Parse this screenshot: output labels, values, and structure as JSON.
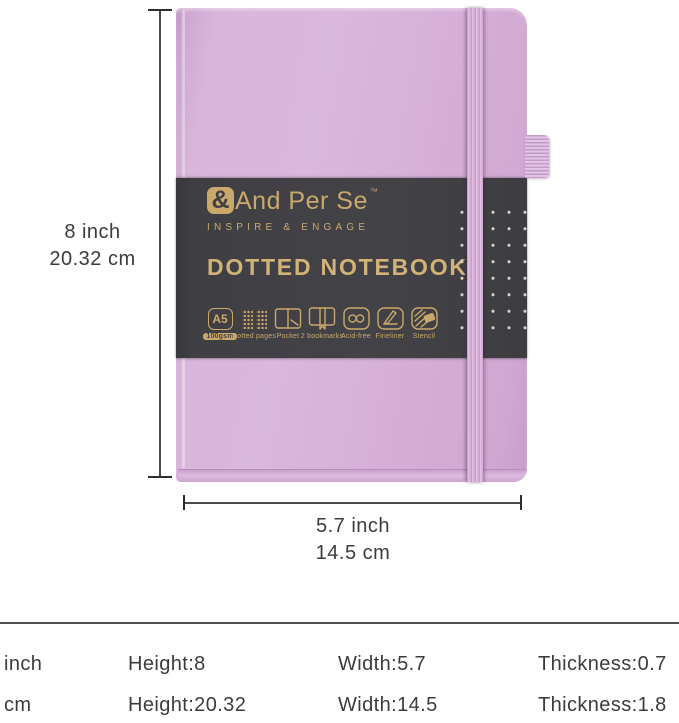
{
  "colors": {
    "cover": "#d6b0d8",
    "belly_band": "#403f44",
    "gold_foil": "#c9a96b",
    "annotation_text": "#3b3b3b"
  },
  "brand": {
    "mark": "&",
    "name": "And Per Se",
    "trademark": "™",
    "tagline": "INSPIRE & ENGAGE"
  },
  "product": {
    "title": "DOTTED NOTEBOOK",
    "features": [
      {
        "icon": "a5-paper-size-icon",
        "badge": "A5",
        "label": "100gsm"
      },
      {
        "icon": "dotted-pages-icon",
        "label": "Dotted pages"
      },
      {
        "icon": "pocket-icon",
        "label": "Pocket"
      },
      {
        "icon": "two-bookmarks-icon",
        "label": "2 bookmarks"
      },
      {
        "icon": "acid-free-icon",
        "label": "Acid-free"
      },
      {
        "icon": "fineliner-icon",
        "label": "Fineliner"
      },
      {
        "icon": "stencil-icon",
        "label": "Stencil"
      }
    ]
  },
  "dimensions": {
    "height": {
      "inch": "8 inch",
      "cm": "20.32 cm"
    },
    "width": {
      "inch": "5.7 inch",
      "cm": "14.5 cm"
    }
  },
  "spec_table": {
    "rows": [
      {
        "unit": "inch",
        "height": "Height:8",
        "width": "Width:5.7",
        "thickness": "Thickness:0.7"
      },
      {
        "unit": "cm",
        "height": "Height:20.32",
        "width": "Width:14.5",
        "thickness": "Thickness:1.8"
      }
    ]
  }
}
